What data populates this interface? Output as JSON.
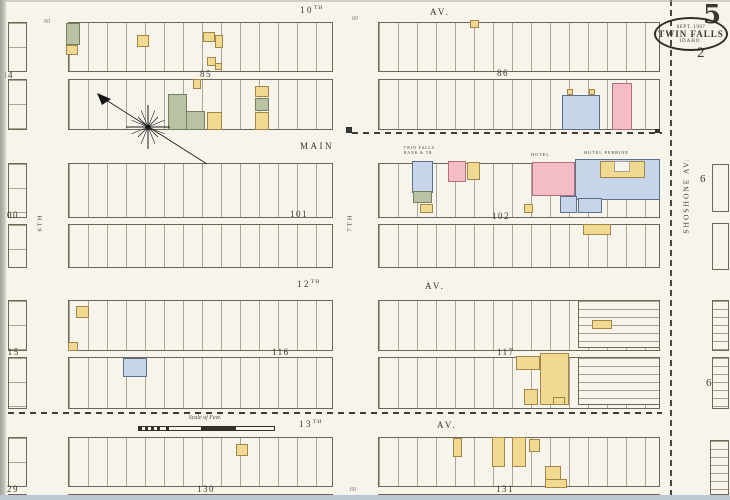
{
  "sheet": {
    "number": "5",
    "date": "SEPT. 1907",
    "city": "TWIN FALLS",
    "state": "IDAHO.",
    "page": "2"
  },
  "streets": {
    "tenth_num": "10",
    "tenth_suf": "TH",
    "tenth_av": "AV.",
    "main": "MAIN",
    "twelfth_num": "12",
    "twelfth_suf": "TH",
    "twelfth_av": "AV.",
    "thirteenth_num": "13",
    "thirteenth_suf": "TH",
    "thirteenth_av": "AV.",
    "seventh": "7TH",
    "sixth": "6TH",
    "shoshone": "SHOSHONE AV."
  },
  "blocks": {
    "b84": "84",
    "b85": "85",
    "b86": "86",
    "b100": "100",
    "b101": "101",
    "b102": "102",
    "b115": "115",
    "b116": "116",
    "b117": "117",
    "b129": "129",
    "b130": "130",
    "b131": "131",
    "b6_upper": "6",
    "b6_lower": "6"
  },
  "labels": {
    "scale": "Scale of Feet.",
    "hotel1": "HOTEL",
    "hotel2": "HOTEL PERRINE",
    "bank_line1": "TWIN FALLS",
    "bank_line2": "BANK & TR."
  },
  "annotations": {
    "w1": "60",
    "w2": "60",
    "w3": "60"
  },
  "colors": {
    "paper": "#f7f4ec",
    "yellow": "#f0da92",
    "pink": "#f3bcc6",
    "blue": "#c6d5e9",
    "green": "#b9c3a4",
    "dark": "#3a3a36",
    "line": "#6f6755",
    "ink": "#3e3a30"
  },
  "buildings": [
    {
      "x": 66,
      "y": 23,
      "w": 14,
      "h": 22,
      "c": "green"
    },
    {
      "x": 66,
      "y": 45,
      "w": 12,
      "h": 10,
      "c": "yellow"
    },
    {
      "x": 137,
      "y": 35,
      "w": 12,
      "h": 12,
      "c": "yellow"
    },
    {
      "x": 203,
      "y": 32,
      "w": 12,
      "h": 10,
      "c": "yellow"
    },
    {
      "x": 215,
      "y": 35,
      "w": 8,
      "h": 13,
      "c": "yellow"
    },
    {
      "x": 207,
      "y": 57,
      "w": 9,
      "h": 9,
      "c": "yellow"
    },
    {
      "x": 215,
      "y": 63,
      "w": 7,
      "h": 7,
      "c": "yellow"
    },
    {
      "x": 470,
      "y": 20,
      "w": 9,
      "h": 8,
      "c": "yellow"
    },
    {
      "x": 193,
      "y": 79,
      "w": 8,
      "h": 10,
      "c": "yellow"
    },
    {
      "x": 168,
      "y": 94,
      "w": 19,
      "h": 36,
      "c": "green"
    },
    {
      "x": 186,
      "y": 111,
      "w": 19,
      "h": 19,
      "c": "green"
    },
    {
      "x": 207,
      "y": 112,
      "w": 15,
      "h": 18,
      "c": "yellow"
    },
    {
      "x": 255,
      "y": 86,
      "w": 14,
      "h": 11,
      "c": "yellow"
    },
    {
      "x": 255,
      "y": 98,
      "w": 14,
      "h": 13,
      "c": "green"
    },
    {
      "x": 255,
      "y": 112,
      "w": 14,
      "h": 18,
      "c": "yellow"
    },
    {
      "x": 562,
      "y": 95,
      "w": 38,
      "h": 35,
      "c": "blue"
    },
    {
      "x": 612,
      "y": 83,
      "w": 20,
      "h": 47,
      "c": "pink"
    },
    {
      "x": 567,
      "y": 89,
      "w": 6,
      "h": 6,
      "c": "yellow"
    },
    {
      "x": 589,
      "y": 89,
      "w": 6,
      "h": 6,
      "c": "yellow"
    },
    {
      "x": 412,
      "y": 161,
      "w": 21,
      "h": 32,
      "c": "blue"
    },
    {
      "x": 413,
      "y": 191,
      "w": 19,
      "h": 12,
      "c": "green"
    },
    {
      "x": 420,
      "y": 204,
      "w": 13,
      "h": 9,
      "c": "yellow"
    },
    {
      "x": 448,
      "y": 161,
      "w": 18,
      "h": 21,
      "c": "pink"
    },
    {
      "x": 467,
      "y": 162,
      "w": 13,
      "h": 18,
      "c": "yellow"
    },
    {
      "x": 532,
      "y": 162,
      "w": 43,
      "h": 34,
      "c": "pink"
    },
    {
      "x": 575,
      "y": 159,
      "w": 85,
      "h": 41,
      "c": "blue"
    },
    {
      "x": 600,
      "y": 161,
      "w": 45,
      "h": 17,
      "c": "yellow"
    },
    {
      "x": 614,
      "y": 161,
      "w": 16,
      "h": 11,
      "c": "paper"
    },
    {
      "x": 560,
      "y": 196,
      "w": 17,
      "h": 17,
      "c": "blue"
    },
    {
      "x": 578,
      "y": 198,
      "w": 24,
      "h": 15,
      "c": "blue"
    },
    {
      "x": 524,
      "y": 204,
      "w": 9,
      "h": 9,
      "c": "yellow"
    },
    {
      "x": 583,
      "y": 224,
      "w": 28,
      "h": 11,
      "c": "yellow"
    },
    {
      "x": 76,
      "y": 306,
      "w": 13,
      "h": 12,
      "c": "yellow"
    },
    {
      "x": 68,
      "y": 342,
      "w": 10,
      "h": 9,
      "c": "yellow",
      "xm": true
    },
    {
      "x": 123,
      "y": 358,
      "w": 24,
      "h": 19,
      "c": "blue"
    },
    {
      "x": 592,
      "y": 320,
      "w": 20,
      "h": 9,
      "c": "yellow"
    },
    {
      "x": 516,
      "y": 356,
      "w": 24,
      "h": 14,
      "c": "yellow"
    },
    {
      "x": 540,
      "y": 353,
      "w": 29,
      "h": 52,
      "c": "yellow",
      "xm": true
    },
    {
      "x": 524,
      "y": 389,
      "w": 14,
      "h": 16,
      "c": "yellow"
    },
    {
      "x": 553,
      "y": 397,
      "w": 12,
      "h": 8,
      "c": "yellow"
    },
    {
      "x": 236,
      "y": 444,
      "w": 12,
      "h": 12,
      "c": "yellow"
    },
    {
      "x": 453,
      "y": 438,
      "w": 9,
      "h": 19,
      "c": "yellow"
    },
    {
      "x": 492,
      "y": 437,
      "w": 13,
      "h": 30,
      "c": "yellow",
      "xm": true
    },
    {
      "x": 512,
      "y": 437,
      "w": 14,
      "h": 30,
      "c": "yellow",
      "xm": true
    },
    {
      "x": 529,
      "y": 439,
      "w": 11,
      "h": 13,
      "c": "yellow"
    },
    {
      "x": 545,
      "y": 466,
      "w": 16,
      "h": 14,
      "c": "yellow"
    },
    {
      "x": 545,
      "y": 479,
      "w": 22,
      "h": 9,
      "c": "yellow"
    },
    {
      "x": 346,
      "y": 127,
      "w": 6,
      "h": 6,
      "c": "dark"
    },
    {
      "x": 655,
      "y": 129,
      "w": 5,
      "h": 4,
      "c": "dark"
    }
  ]
}
